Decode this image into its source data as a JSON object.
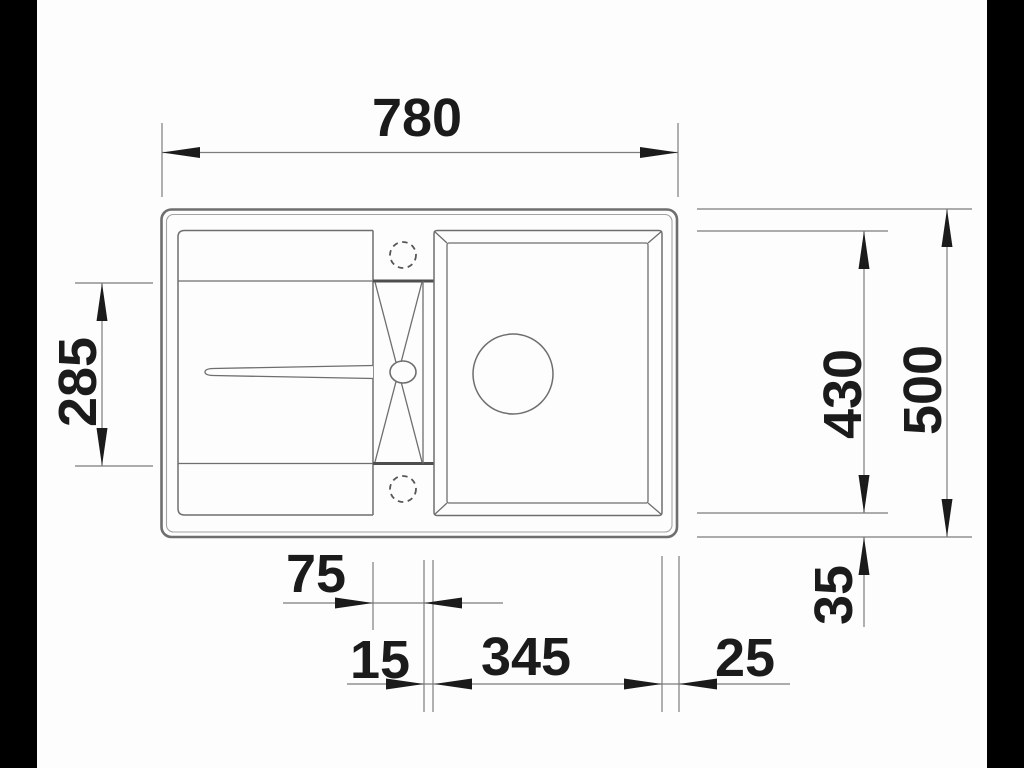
{
  "document": {
    "type": "technical dimension drawing",
    "subject": "kitchen sink with drainboard, tap ledge and single bowl — top view",
    "units": "mm"
  },
  "colors": {
    "line-main": "#6e6e6e",
    "line-light": "#a3a3a3",
    "line-dark": "#4e4e4e",
    "dim-line": "#7d7d7d",
    "ink": "#1b1b1b",
    "paper": "#fdfdfd",
    "letterbox": "#000000"
  },
  "dimensions": {
    "overall_width": {
      "value": "780",
      "orientation": "horizontal",
      "position": "top"
    },
    "drainer_depth": {
      "value": "285",
      "orientation": "vertical",
      "position": "left"
    },
    "bowl_offset_depth": {
      "value": "430",
      "orientation": "vertical",
      "position": "right"
    },
    "overall_depth": {
      "value": "500",
      "orientation": "vertical",
      "position": "right"
    },
    "bottom_margin": {
      "value": "35",
      "orientation": "vertical",
      "position": "right"
    },
    "tap_ledge_width": {
      "value": "75",
      "orientation": "horizontal",
      "position": "bottom"
    },
    "divider_width": {
      "value": "15",
      "orientation": "horizontal",
      "position": "bottom"
    },
    "bowl_width": {
      "value": "345",
      "orientation": "horizontal",
      "position": "bottom"
    },
    "right_margin": {
      "value": "25",
      "orientation": "horizontal",
      "position": "bottom"
    }
  }
}
